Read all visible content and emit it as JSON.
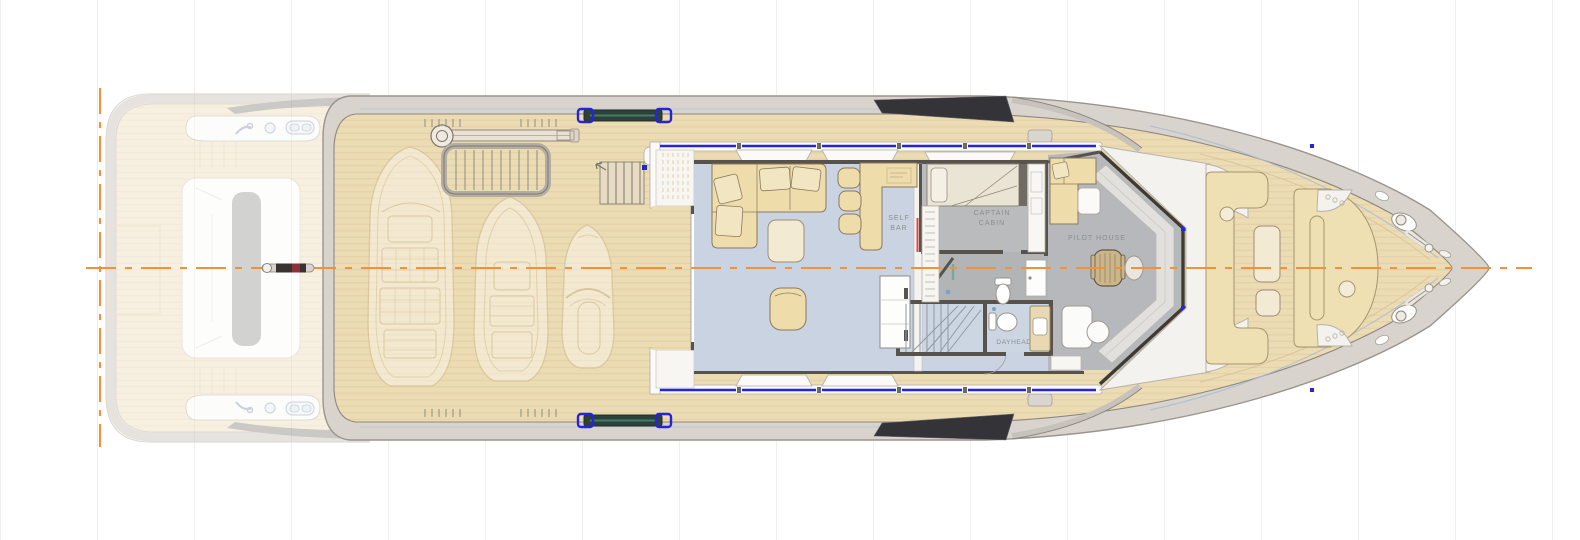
{
  "plan": {
    "labels": {
      "self_bar_line1": "SELF",
      "self_bar_line2": "BAR",
      "captain_cabin_line1": "CAPTAIN",
      "captain_cabin_line2": "CABIN",
      "pilot_house": "PILOT HOUSE",
      "dayhead": "DAYHEAD"
    },
    "colors": {
      "centerline_orange": "#F0923C",
      "deck_wood": "#ECDCB4",
      "salon_floor": "#CAD3E1",
      "technical_floor": "#B9BBBD",
      "furniture_cream": "#EEDCAB",
      "window_blue": "#2424DC",
      "accent_red": "#E04848",
      "glazing_dark": "#333338",
      "hull_gray": "#D8D3CC"
    }
  }
}
